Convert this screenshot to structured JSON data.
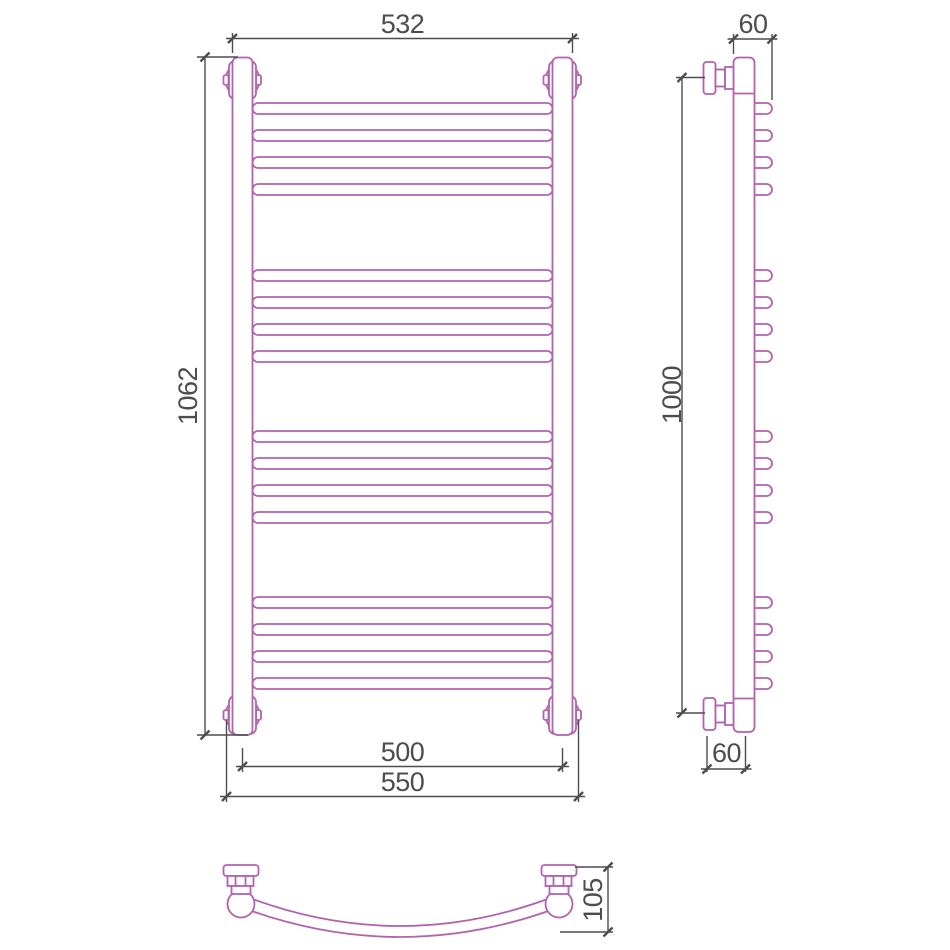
{
  "views": {
    "front": {
      "dim_top_width": "532",
      "dim_height": "1062",
      "dim_bottom_center_width": "500",
      "dim_bottom_outer_width": "550"
    },
    "side": {
      "dim_top_depth": "60",
      "dim_height": "1000",
      "dim_bottom_depth": "60"
    },
    "plan": {
      "dim_depth": "105"
    }
  },
  "colors": {
    "product_outline": "#b163ae",
    "dimension_lines": "#4d4d4d",
    "background": "#ffffff"
  }
}
